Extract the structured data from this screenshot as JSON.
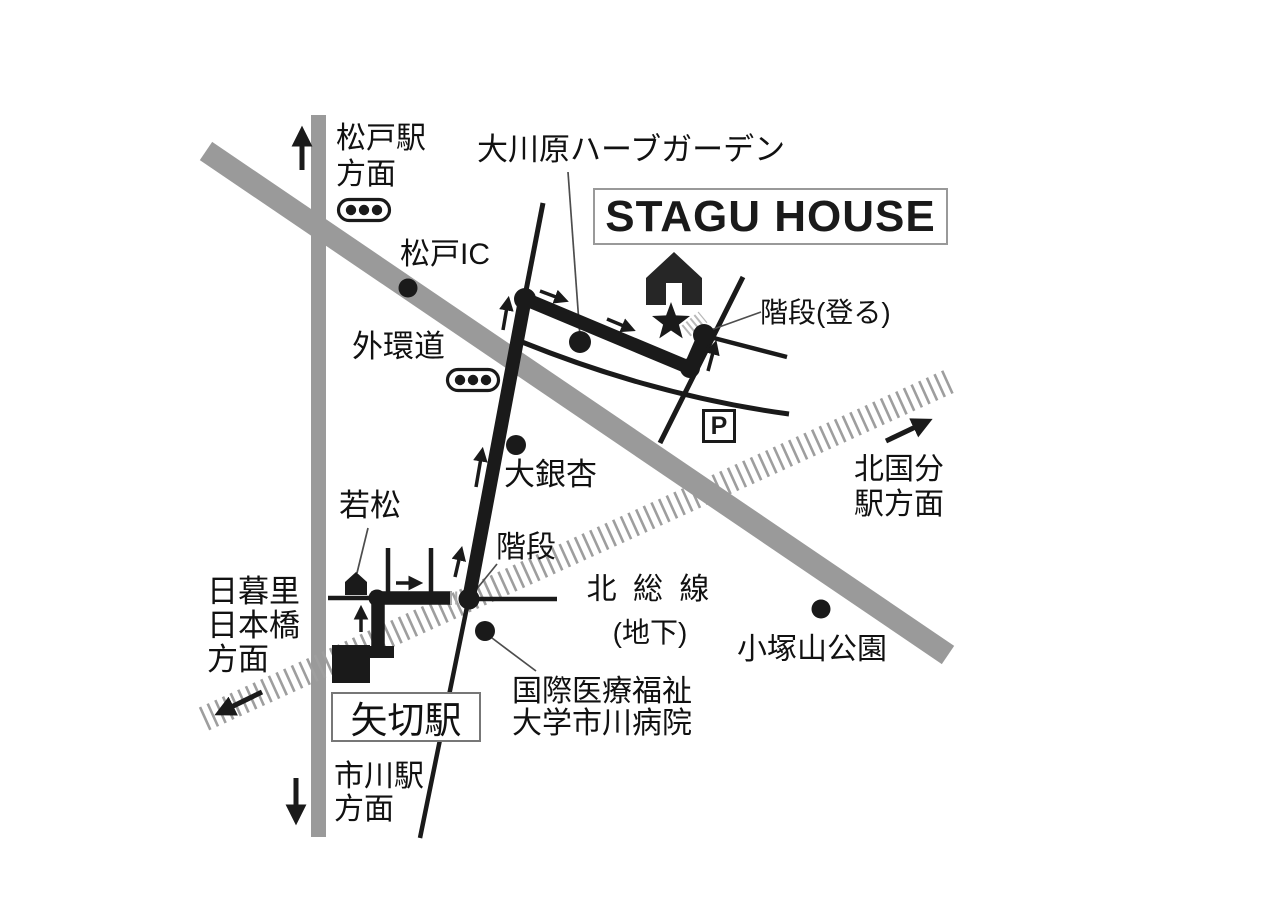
{
  "map_title": "STAGU HOUSE",
  "colors": {
    "ink": "#1a1a1a",
    "road_gray": "#9a9a9a",
    "railway_gray": "#9e9e9e",
    "stairs_hatch": "#b0b0b0",
    "title_border": "#999999",
    "station_box_border": "#777777"
  },
  "labels": {
    "matsudo_station_direction": "松戸駅\n方面",
    "okawara_herb_garden": "大川原ハーブガーデン",
    "stairs_up": "階段(登る)",
    "matsudo_ic": "松戸IC",
    "gaikando": "外環道",
    "kitakokubun_direction": "北国分\n駅方面",
    "big_ginkgo": "大銀杏",
    "wakamatsu": "若松",
    "stairs": "階段",
    "hokuso_line": "北 総 線",
    "hokuso_line_sub": "(地下)",
    "kozukayama_park": "小塚山公園",
    "nippori_direction": "日暮里\n日本橋\n方面",
    "yagiri_station": "矢切駅",
    "hospital": "国際医療福祉\n大学市川病院",
    "ichikawa_direction": "市川駅\n方面",
    "parking": "P"
  },
  "icons": {
    "destination_house": "house-icon",
    "destination_star": "star-icon",
    "traffic_lights": 2,
    "parking_sign": "parking-icon"
  }
}
